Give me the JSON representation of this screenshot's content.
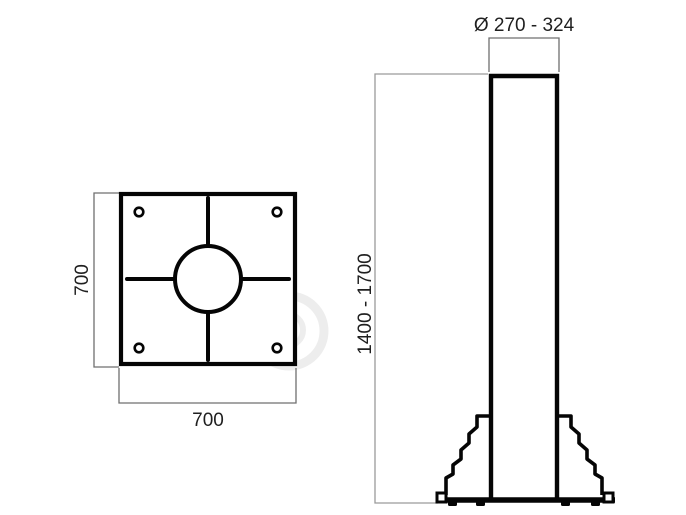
{
  "title": "Pole and base plate technical drawing",
  "colors": {
    "background": "#ffffff",
    "outline": "#050505",
    "dimension_line": "#6f6f6f",
    "extension_line": "#9a9a9a",
    "text": "#1f1f1f"
  },
  "top_view": {
    "description": "base plate top view with center hole, crosshair slots and 4 bolt holes",
    "side_label": "700",
    "bottom_label": "700"
  },
  "side_view": {
    "description": "pole elevation with stepped gussets and anchor base",
    "diameter_label": "Ø 270 - 324",
    "height_label": "1400 - 1700"
  }
}
